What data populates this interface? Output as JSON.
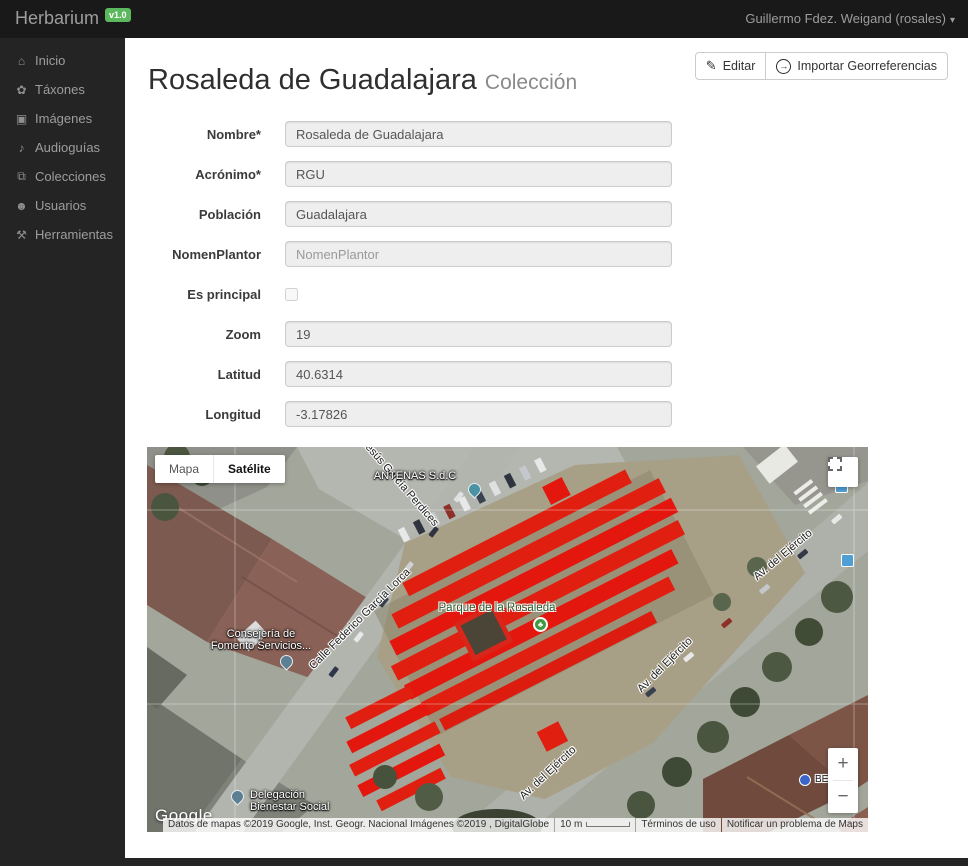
{
  "header": {
    "brand": "Herbarium",
    "version_badge": "v1.0",
    "user_menu": "Guillermo Fdez. Weigand (rosales)",
    "caret_glyph": "▾"
  },
  "sidebar": {
    "items": [
      {
        "label": "Inicio",
        "icon": "home-icon",
        "glyph": "⌂"
      },
      {
        "label": "Táxones",
        "icon": "plant-icon",
        "glyph": "✿"
      },
      {
        "label": "Imágenes",
        "icon": "image-icon",
        "glyph": "▣"
      },
      {
        "label": "Audioguías",
        "icon": "audio-guide-icon",
        "glyph": "♪"
      },
      {
        "label": "Colecciones",
        "icon": "collections-icon",
        "glyph": "⧉"
      },
      {
        "label": "Usuarios",
        "icon": "users-icon",
        "glyph": "☻"
      },
      {
        "label": "Herramientas",
        "icon": "tools-icon",
        "glyph": "⚒"
      }
    ]
  },
  "page": {
    "title": "Rosaleda de Guadalajara",
    "subtitle": "Colección",
    "actions": {
      "edit_label": "Editar",
      "edit_icon_glyph": "✎",
      "import_label": "Importar Georreferencias",
      "import_icon_glyph": "→"
    }
  },
  "form": {
    "fields": [
      {
        "label": "Nombre*",
        "value": "Rosaleda de Guadalajara"
      },
      {
        "label": "Acrónimo*",
        "value": "RGU"
      },
      {
        "label": "Población",
        "value": "Guadalajara"
      },
      {
        "label": "NomenPlantor",
        "value": "",
        "placeholder": "NomenPlantor"
      },
      {
        "label": "Es principal",
        "type": "checkbox",
        "checked": false
      },
      {
        "label": "Zoom",
        "value": "19"
      },
      {
        "label": "Latitud",
        "value": "40.6314"
      },
      {
        "label": "Longitud",
        "value": "-3.17826"
      }
    ]
  },
  "map": {
    "type_control": {
      "map_label": "Mapa",
      "satellite_label": "Satélite",
      "active": "Satélite"
    },
    "zoom_control": {
      "zoom_in": "+",
      "zoom_out": "−"
    },
    "street_labels": {
      "perdices": "Jesús García Perdices",
      "lorca": "Calle Federico García Lorca",
      "ejercito_1": "Av. del Ejército",
      "ejercito_2": "Av. del Ejército",
      "ejercito_3": "Av. del Ejército"
    },
    "poi_labels": {
      "antenas": "ANTENAS S.d.C",
      "consejeria_line1": "Consejería de",
      "consejeria_line2": "Fomento Servicios...",
      "parque": "Parque de la Rosaleda",
      "delegacion_line1": "Delegación",
      "delegacion_line2": "Bienestar Social",
      "bus_stop": "BE"
    },
    "attribution": {
      "logo": "Google",
      "data_text": "Datos de mapas ©2019 Google, Inst. Geogr. Nacional Imágenes ©2019 , DigitalGlobe",
      "scale_text": "10 m",
      "terms_link": "Términos de uso",
      "report_link": "Notificar un problema de Maps"
    },
    "overlay_color": "#e3170d"
  },
  "colors": {
    "badge_green": "#5cb85c",
    "topbar_bg": "#191919",
    "sidebar_bg": "#242424",
    "highlight_red": "#e3170d"
  }
}
